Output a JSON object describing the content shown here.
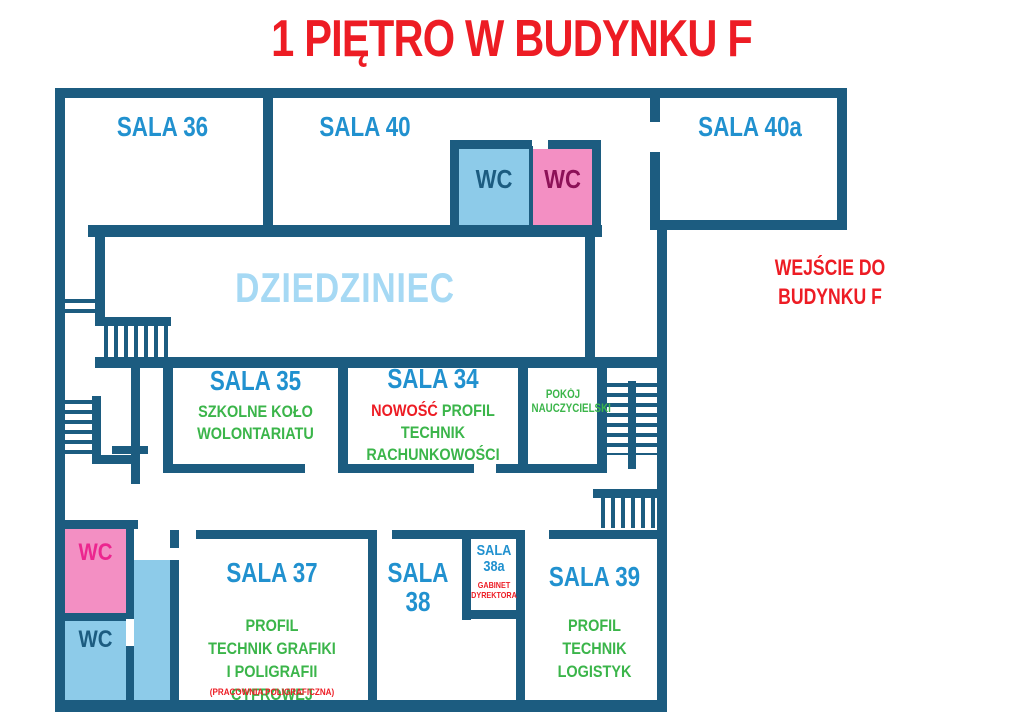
{
  "title": "1 PIĘTRO W BUDYNKU F",
  "colors": {
    "wall": "#1c5c80",
    "room_label": "#2191cf",
    "profile_green": "#3bb54a",
    "accent_red": "#ed1c24",
    "courtyard_text": "#a6d9f4",
    "wc_blue_fill": "#8dcbe9",
    "wc_pink_fill": "#f38fc3",
    "wc_text_dark": "#1c5c80",
    "wc_text_magenta_dark": "#8c1157",
    "wc_text_magenta": "#ec268f"
  },
  "entrance": {
    "lines": [
      "WEJŚCIE DO",
      "BUDYNKU F"
    ]
  },
  "courtyard": {
    "name": "DZIEDZINIEC"
  },
  "rooms": {
    "sala36": {
      "name": "SALA 36"
    },
    "sala40": {
      "name": "SALA 40"
    },
    "sala40a": {
      "name": "SALA 40a"
    },
    "sala35": {
      "name": "SALA 35",
      "lines": [
        "SZKOLNE KOŁO",
        "WOLONTARIATU"
      ]
    },
    "sala34": {
      "name": "SALA 34",
      "badge": "NOWOŚĆ",
      "profile_word": "PROFIL",
      "line2": "TECHNIK RACHUNKOWOŚCI"
    },
    "pokoj_nauczycielski": {
      "lines": [
        "POKÓJ",
        "NAUCZYCIELSKI"
      ]
    },
    "sala37": {
      "name": "SALA 37",
      "lines": [
        "PROFIL",
        "TECHNIK GRAFIKI",
        "I POLIGRAFII CYFROWEJ"
      ],
      "note": "(PRACOWNIA POLIGRAFICZNA)"
    },
    "sala38": {
      "name": "SALA 38"
    },
    "sala38a": {
      "name_lines": [
        "SALA",
        "38a"
      ],
      "note_lines": [
        "GABINET",
        "DYREKTORA"
      ]
    },
    "sala39": {
      "name": "SALA 39",
      "lines": [
        "PROFIL",
        "TECHNIK LOGISTYK"
      ]
    },
    "wc_top_blue": {
      "label": "WC"
    },
    "wc_top_pink": {
      "label": "WC"
    },
    "wc_bottom_pink": {
      "label": "WC"
    },
    "wc_bottom_blue": {
      "label": "WC"
    }
  }
}
